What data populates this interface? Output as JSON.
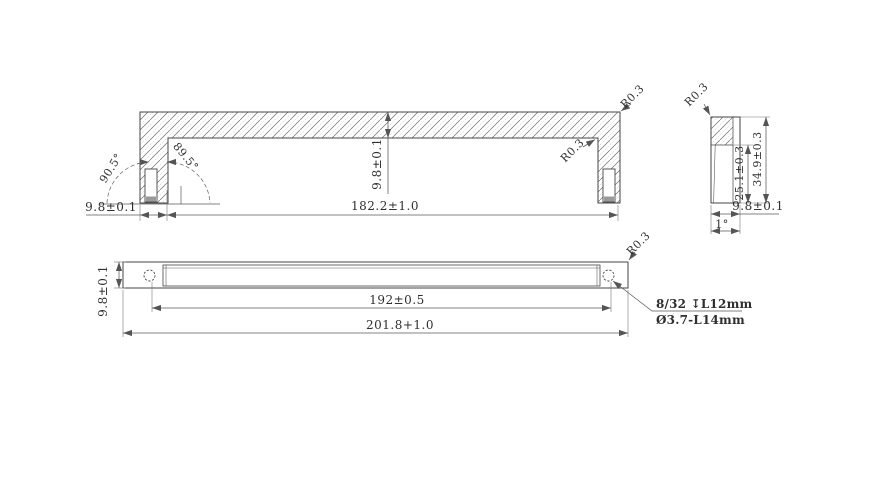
{
  "colors": {
    "background": "#ffffff",
    "outline": "#454545",
    "dimension_line": "#5a5a5a",
    "hatch": "#6f6f6f",
    "text": "#2f2f2f"
  },
  "section_view": {
    "end_offset": "9.8±0.1",
    "inner_length": "182.2±1.0",
    "thickness": "9.8±0.1",
    "angle_left": "90.5°",
    "angle_right": "89.5°",
    "inner_radius": "R0.3",
    "corner_radius": "R0.3"
  },
  "side_view": {
    "corner_radius": "R0.3",
    "inner_height": "25.1±0.3",
    "overall_height": "34.9±0.3",
    "width": "9.8±0.1",
    "draft_angle": "1°"
  },
  "plan_view": {
    "depth": "9.8±0.1",
    "hole_spacing": "192±0.5",
    "overall_length": "201.8+1.0",
    "corner_radius": "R0.3",
    "thread_note_line1": "8/32 ↧L12mm",
    "thread_note_line2": "Ø3.7-L14mm"
  }
}
